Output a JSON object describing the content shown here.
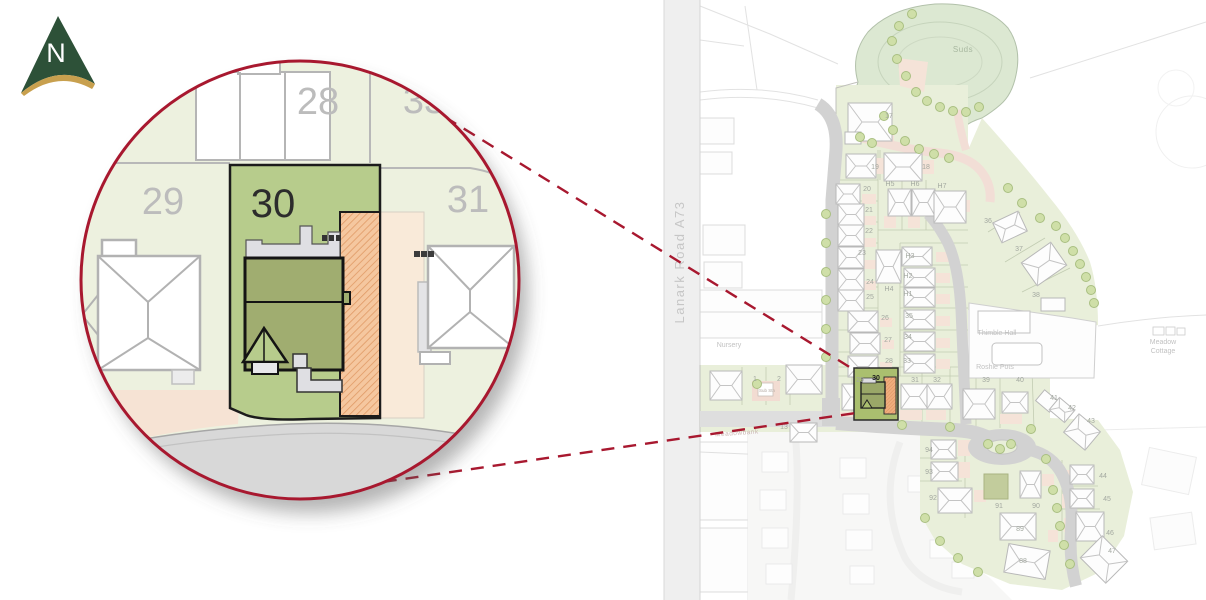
{
  "compass": {
    "label": "N"
  },
  "magnifier": {
    "labels": [
      {
        "text": "28",
        "x": 318,
        "y": 114,
        "cls": "mag-num"
      },
      {
        "text": "33",
        "x": 424,
        "y": 113,
        "cls": "mag-num"
      },
      {
        "text": "29",
        "x": 163,
        "y": 214,
        "cls": "mag-num"
      },
      {
        "text": "30",
        "x": 273,
        "y": 217,
        "cls": "mag-num-active"
      },
      {
        "text": "31",
        "x": 468,
        "y": 212,
        "cls": "mag-num"
      }
    ]
  },
  "map": {
    "road_label": "Lanark Road A73",
    "highlight_label": [
      {
        "text": "30",
        "x": 876,
        "y": 380,
        "cls": "map-num-bold"
      }
    ],
    "place_labels": [
      {
        "text": "Suds",
        "x": 963,
        "y": 52,
        "cls": "suds"
      },
      {
        "text": "Nursery",
        "x": 729,
        "y": 347,
        "cls": "map-place"
      },
      {
        "text": "Thimble Hall",
        "x": 997,
        "y": 335,
        "cls": "map-place"
      },
      {
        "text": "Roshie Pots",
        "x": 995,
        "y": 369,
        "cls": "map-place"
      },
      {
        "text": "Meadow",
        "x": 1163,
        "y": 344,
        "cls": "map-place"
      },
      {
        "text": "Cottage",
        "x": 1163,
        "y": 353,
        "cls": "map-place"
      },
      {
        "text": "Meadowbank",
        "x": 737,
        "y": 435,
        "cls": "faded-street",
        "rot": -4
      },
      {
        "text": "Sub Stn",
        "x": 767,
        "y": 392,
        "cls": "map-tiny"
      }
    ],
    "plot_labels": [
      {
        "text": "17",
        "x": 889,
        "y": 118
      },
      {
        "text": "19",
        "x": 875,
        "y": 169
      },
      {
        "text": "18",
        "x": 926,
        "y": 169
      },
      {
        "text": "20",
        "x": 867,
        "y": 191
      },
      {
        "text": "H5",
        "x": 890,
        "y": 186
      },
      {
        "text": "H6",
        "x": 915,
        "y": 186
      },
      {
        "text": "H7",
        "x": 942,
        "y": 188
      },
      {
        "text": "21",
        "x": 869,
        "y": 212
      },
      {
        "text": "22",
        "x": 869,
        "y": 233
      },
      {
        "text": "23",
        "x": 862,
        "y": 255
      },
      {
        "text": "24",
        "x": 870,
        "y": 284
      },
      {
        "text": "25",
        "x": 870,
        "y": 299
      },
      {
        "text": "H3",
        "x": 910,
        "y": 258
      },
      {
        "text": "H2",
        "x": 908,
        "y": 278
      },
      {
        "text": "H4",
        "x": 889,
        "y": 291
      },
      {
        "text": "H1",
        "x": 908,
        "y": 296
      },
      {
        "text": "26",
        "x": 885,
        "y": 320
      },
      {
        "text": "35",
        "x": 909,
        "y": 318
      },
      {
        "text": "27",
        "x": 888,
        "y": 342
      },
      {
        "text": "34",
        "x": 908,
        "y": 339
      },
      {
        "text": "28",
        "x": 889,
        "y": 363
      },
      {
        "text": "33",
        "x": 907,
        "y": 363
      },
      {
        "text": "29",
        "x": 860,
        "y": 382
      },
      {
        "text": "31",
        "x": 915,
        "y": 382
      },
      {
        "text": "32",
        "x": 937,
        "y": 382
      },
      {
        "text": "36",
        "x": 988,
        "y": 223
      },
      {
        "text": "37",
        "x": 1019,
        "y": 251
      },
      {
        "text": "38",
        "x": 1036,
        "y": 297
      },
      {
        "text": "39",
        "x": 986,
        "y": 382
      },
      {
        "text": "40",
        "x": 1020,
        "y": 382
      },
      {
        "text": "41",
        "x": 1054,
        "y": 400
      },
      {
        "text": "42",
        "x": 1072,
        "y": 410
      },
      {
        "text": "43",
        "x": 1091,
        "y": 423
      },
      {
        "text": "44",
        "x": 1103,
        "y": 478
      },
      {
        "text": "45",
        "x": 1107,
        "y": 501
      },
      {
        "text": "46",
        "x": 1110,
        "y": 535
      },
      {
        "text": "47",
        "x": 1112,
        "y": 553
      },
      {
        "text": "94",
        "x": 929,
        "y": 452
      },
      {
        "text": "93",
        "x": 929,
        "y": 474
      },
      {
        "text": "92",
        "x": 933,
        "y": 500
      },
      {
        "text": "91",
        "x": 999,
        "y": 508
      },
      {
        "text": "90",
        "x": 1036,
        "y": 508
      },
      {
        "text": "89",
        "x": 1020,
        "y": 531
      },
      {
        "text": "88",
        "x": 1023,
        "y": 563
      },
      {
        "text": "1",
        "x": 755,
        "y": 381
      },
      {
        "text": "2",
        "x": 779,
        "y": 381
      },
      {
        "text": "13",
        "x": 784,
        "y": 429
      }
    ]
  },
  "colors": {
    "accent_red": "#a8182f",
    "compass_green": "#2d5138",
    "compass_gold": "#c8a04e",
    "site_green": "#e9efda",
    "suds_green": "#dce8d2",
    "plot_highlight_green": "#b7cc8c",
    "house_olive": "#9fae6e",
    "driveway_orange": "#f0ad7e",
    "road_gray": "#d6d6d6",
    "path_pink": "#f2ded6"
  }
}
